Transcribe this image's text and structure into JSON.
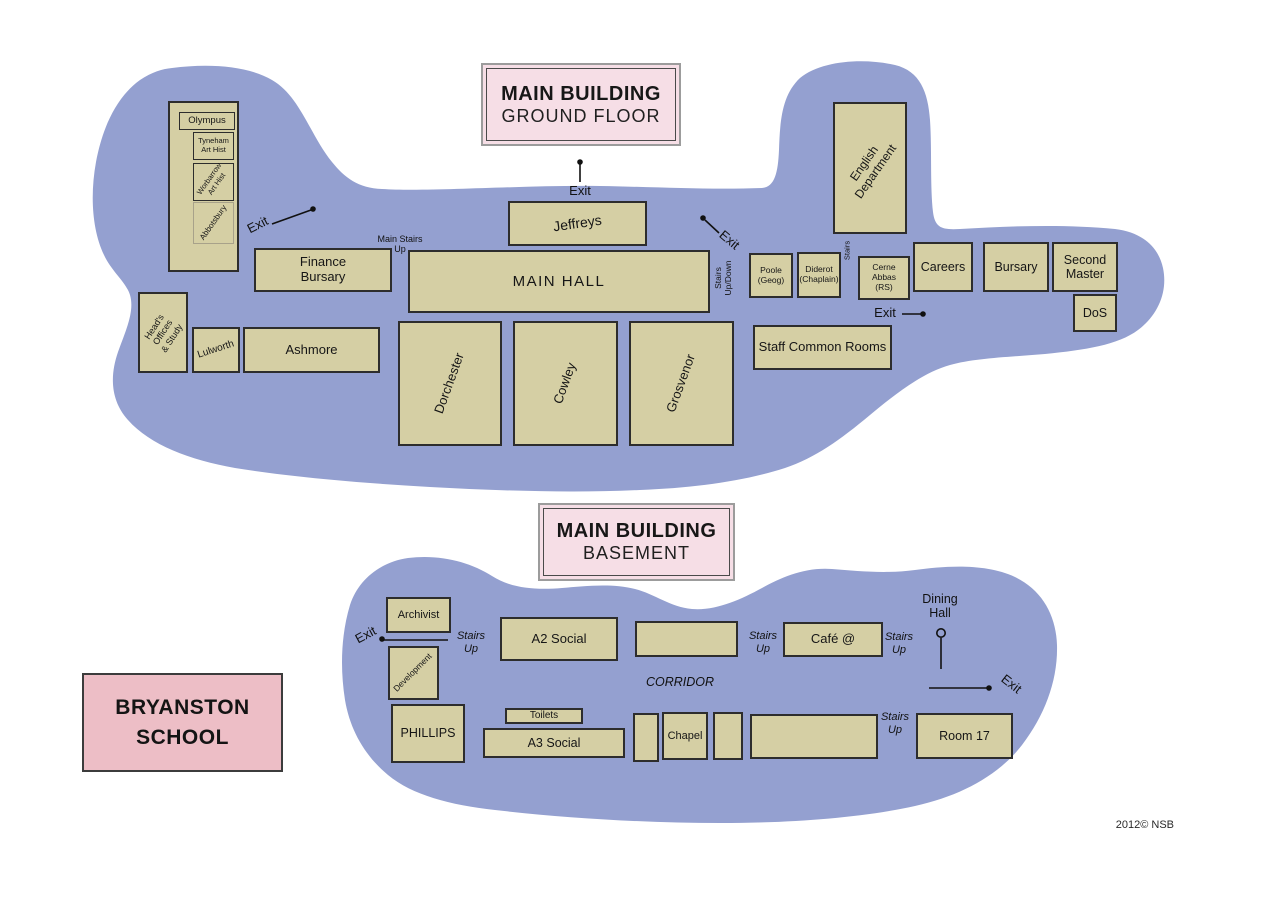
{
  "map_title": "Bryanston School floor plan",
  "credit": "2012© NSB",
  "colors": {
    "background": "#ffffff",
    "building_footprint": "#94a0d0",
    "room_fill": "#d5cfa4",
    "room_border": "#2d2d2d",
    "floor_title_fill": "#f6dee6",
    "school_title_fill": "#edbec6",
    "line": "#111111"
  },
  "titles": {
    "ground": {
      "line1": "MAIN BUILDING",
      "line2": "GROUND FLOOR"
    },
    "basement": {
      "line1": "MAIN BUILDING",
      "line2": "BASEMENT"
    },
    "school": "BRYANSTON\nSCHOOL"
  },
  "gf": {
    "olympus": "Olympus",
    "tyneham": "Tyneham\nArt Hist",
    "worbarrow": "Worbarrow\nArt Hist",
    "abbotsbury": "Abbotsbury",
    "finance": "Finance\nBursary",
    "jeffreys": "Jeffreys",
    "main_hall": "MAIN HALL",
    "poole": "Poole\n(Geog)",
    "diderot": "Diderot\n(Chaplain)",
    "cerne_abbas": "Cerne Abbas\n(RS)",
    "english": "English\nDepartment",
    "careers": "Careers",
    "bursary": "Bursary",
    "second_master": "Second\nMaster",
    "dos": "DoS",
    "heads_offices": "Head's Offices\n& Study",
    "lulworth": "Lulworth",
    "ashmore": "Ashmore",
    "dorchester": "Dorchester",
    "cowley": "Cowley",
    "grosvenor": "Grosvenor",
    "staff_common": "Staff Common Rooms",
    "exit": "Exit",
    "main_stairs": "Main Stairs\nUp",
    "stairs_updown": "Stairs\nUp/Down",
    "stairs": "Stairs"
  },
  "bm": {
    "archivist": "Archivist",
    "development": "Development",
    "phillips": "PHILLIPS",
    "a2_social": "A2 Social",
    "cafe": "Café @",
    "toilets": "Toilets",
    "a3_social": "A3 Social",
    "chapel": "Chapel",
    "room17": "Room 17",
    "exit": "Exit",
    "stairs_up": "Stairs\nUp",
    "corridor": "CORRIDOR",
    "dining_hall": "Dining\nHall"
  }
}
